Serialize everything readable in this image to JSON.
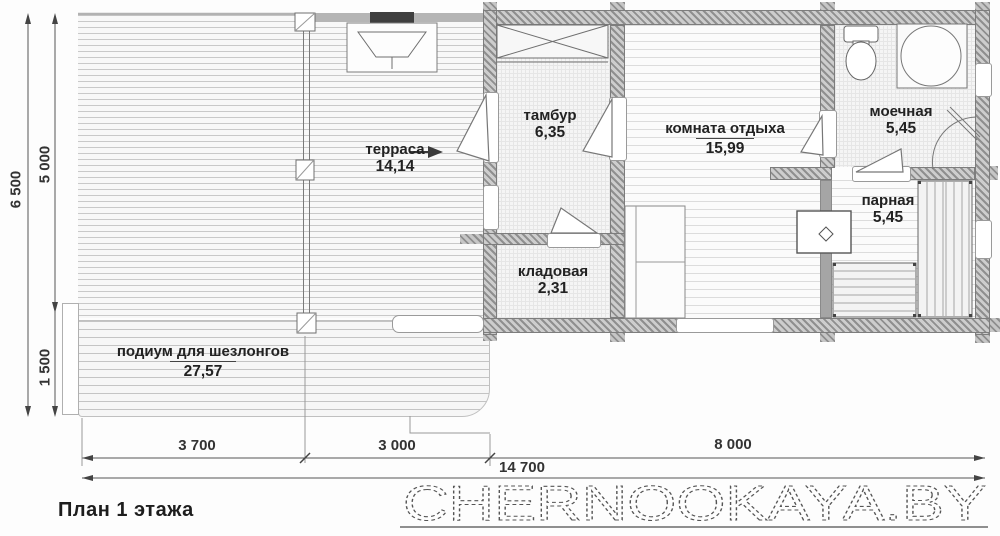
{
  "title": "План 1 этажа",
  "watermark": "CHERNOOKAYA.BY",
  "rooms": [
    {
      "name": "терраса",
      "area": "14,14"
    },
    {
      "name": "тамбур",
      "area": "6,35"
    },
    {
      "name": "комната отдыха",
      "area": "15,99"
    },
    {
      "name": "моечная",
      "area": "5,45"
    },
    {
      "name": "парная",
      "area": "5,45"
    },
    {
      "name": "кладовая",
      "area": "2,31"
    },
    {
      "name": "подиум для шезлонгов",
      "area": "27,57"
    }
  ],
  "dimensions": {
    "left_total": "6 500",
    "left_main": "5 000",
    "left_podium": "1 500",
    "bottom_terrace": "3 700",
    "bottom_porch": "3 000",
    "bottom_house": "8 000",
    "bottom_total": "14 700"
  },
  "colors": {
    "wall_gray": "#8f8f8f",
    "ink": "#222222",
    "watermark_gray": "#555555"
  }
}
